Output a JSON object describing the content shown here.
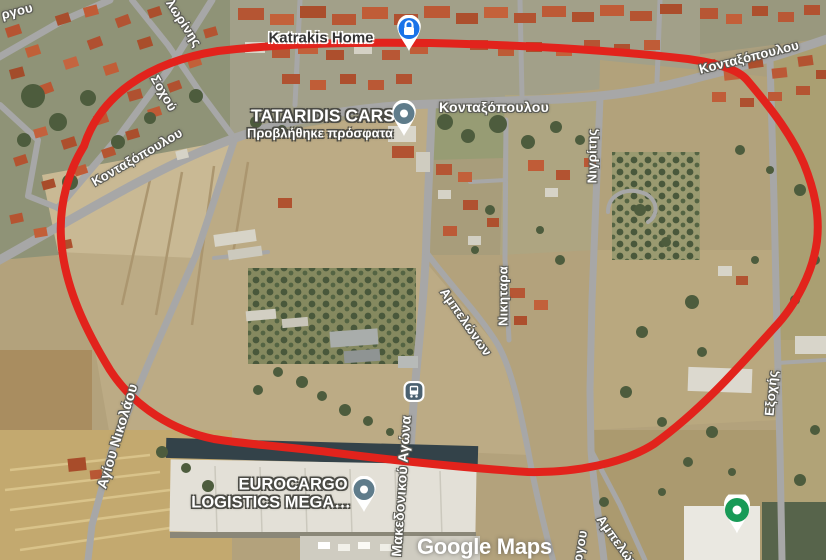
{
  "map": {
    "attribution": "Google Maps",
    "streets": [
      {
        "label": "ργου"
      },
      {
        "label": "λωρίνης"
      },
      {
        "label": "Σοχού"
      },
      {
        "label": "Κονταξόπουλου"
      },
      {
        "label": "Κονταξόπουλου"
      },
      {
        "label": "Κονταξόπουλου"
      },
      {
        "label": "Νιγρίτης"
      },
      {
        "label": "Νικηταρα"
      },
      {
        "label": "Αμπελώνων"
      },
      {
        "label": "Εξοχής"
      },
      {
        "label": "Αγίου Νικολάου"
      },
      {
        "label": "Μακεδονικού Αγώνα"
      },
      {
        "label": "Αμπελώνων"
      },
      {
        "label": "ργου"
      }
    ],
    "pois": [
      {
        "title": "Katrakis Home",
        "icon": "lock-pin",
        "color": "#1a73e8"
      },
      {
        "title": "TATARIDIS CARS",
        "subtitle": "Προβλήθηκε πρόσφατα",
        "icon": "place-pin",
        "color": "#5f7c8b"
      },
      {
        "title_line1": "EUROCARGO",
        "title_line2": "LOGISTICS MEGA…",
        "icon": "place-pin",
        "color": "#5f7c8b"
      },
      {
        "icon": "visited-pin",
        "color": "#189a57"
      },
      {
        "icon": "bus-stop",
        "color": "#4b6170"
      }
    ],
    "annotation": {
      "shape": "hand-drawn-oval",
      "color": "#e2231c"
    }
  }
}
